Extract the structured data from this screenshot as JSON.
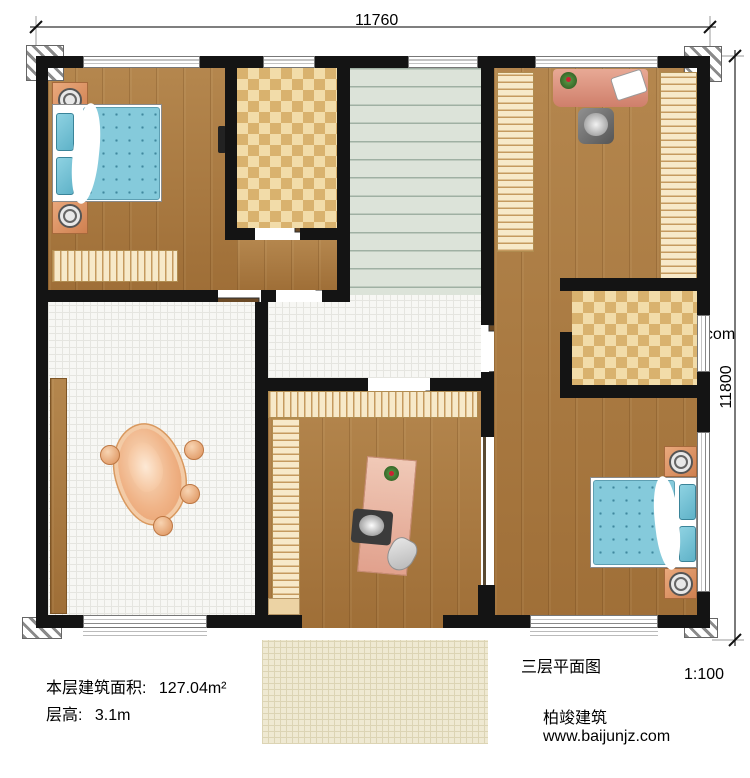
{
  "dimensions": {
    "top": "11760",
    "right": "11800"
  },
  "rooms": [
    {
      "name": "卧室",
      "area": "14.02m²"
    },
    {
      "name": "内卫",
      "area": "4.33m²"
    },
    {
      "name": "衣帽间",
      "area": "13.76m²"
    },
    {
      "name": "楼梯间",
      "area": "15.24m²"
    },
    {
      "name": "内卫",
      "area": "4.18m²"
    },
    {
      "name": "茶室",
      "area": "21.08m²"
    },
    {
      "name": "书房",
      "area": "14.73m²"
    },
    {
      "name": "卧室",
      "area": "16.98m²"
    },
    {
      "name": "阳台",
      "area": "4.16m²"
    }
  ],
  "stairs": {
    "down": "下",
    "up": "上"
  },
  "notes": {
    "area_label": "本层建筑面积:",
    "area_value": "127.04m²",
    "height_label": "层高:",
    "height_value": "3.1m"
  },
  "title": {
    "text": "三层平面图",
    "scale": "1:100"
  },
  "brand": {
    "name": "柏竣建筑",
    "site": "www.baijunjz.com"
  },
  "watermark": {
    "name": "柏竣建筑",
    "site": "www.baijunjz.com"
  },
  "colors": {
    "wall": "#141414",
    "wood": "#aa7a41",
    "checker_light": "#f2dca9",
    "checker_dark": "#d9b26e",
    "stair": "#dce3d9",
    "tile": "#f7f7f4",
    "balcony": "#efe9d2",
    "bed_blue": "#85cadb",
    "logo_blue": "#1f66b0",
    "logo_orange": "#f29a2e"
  }
}
